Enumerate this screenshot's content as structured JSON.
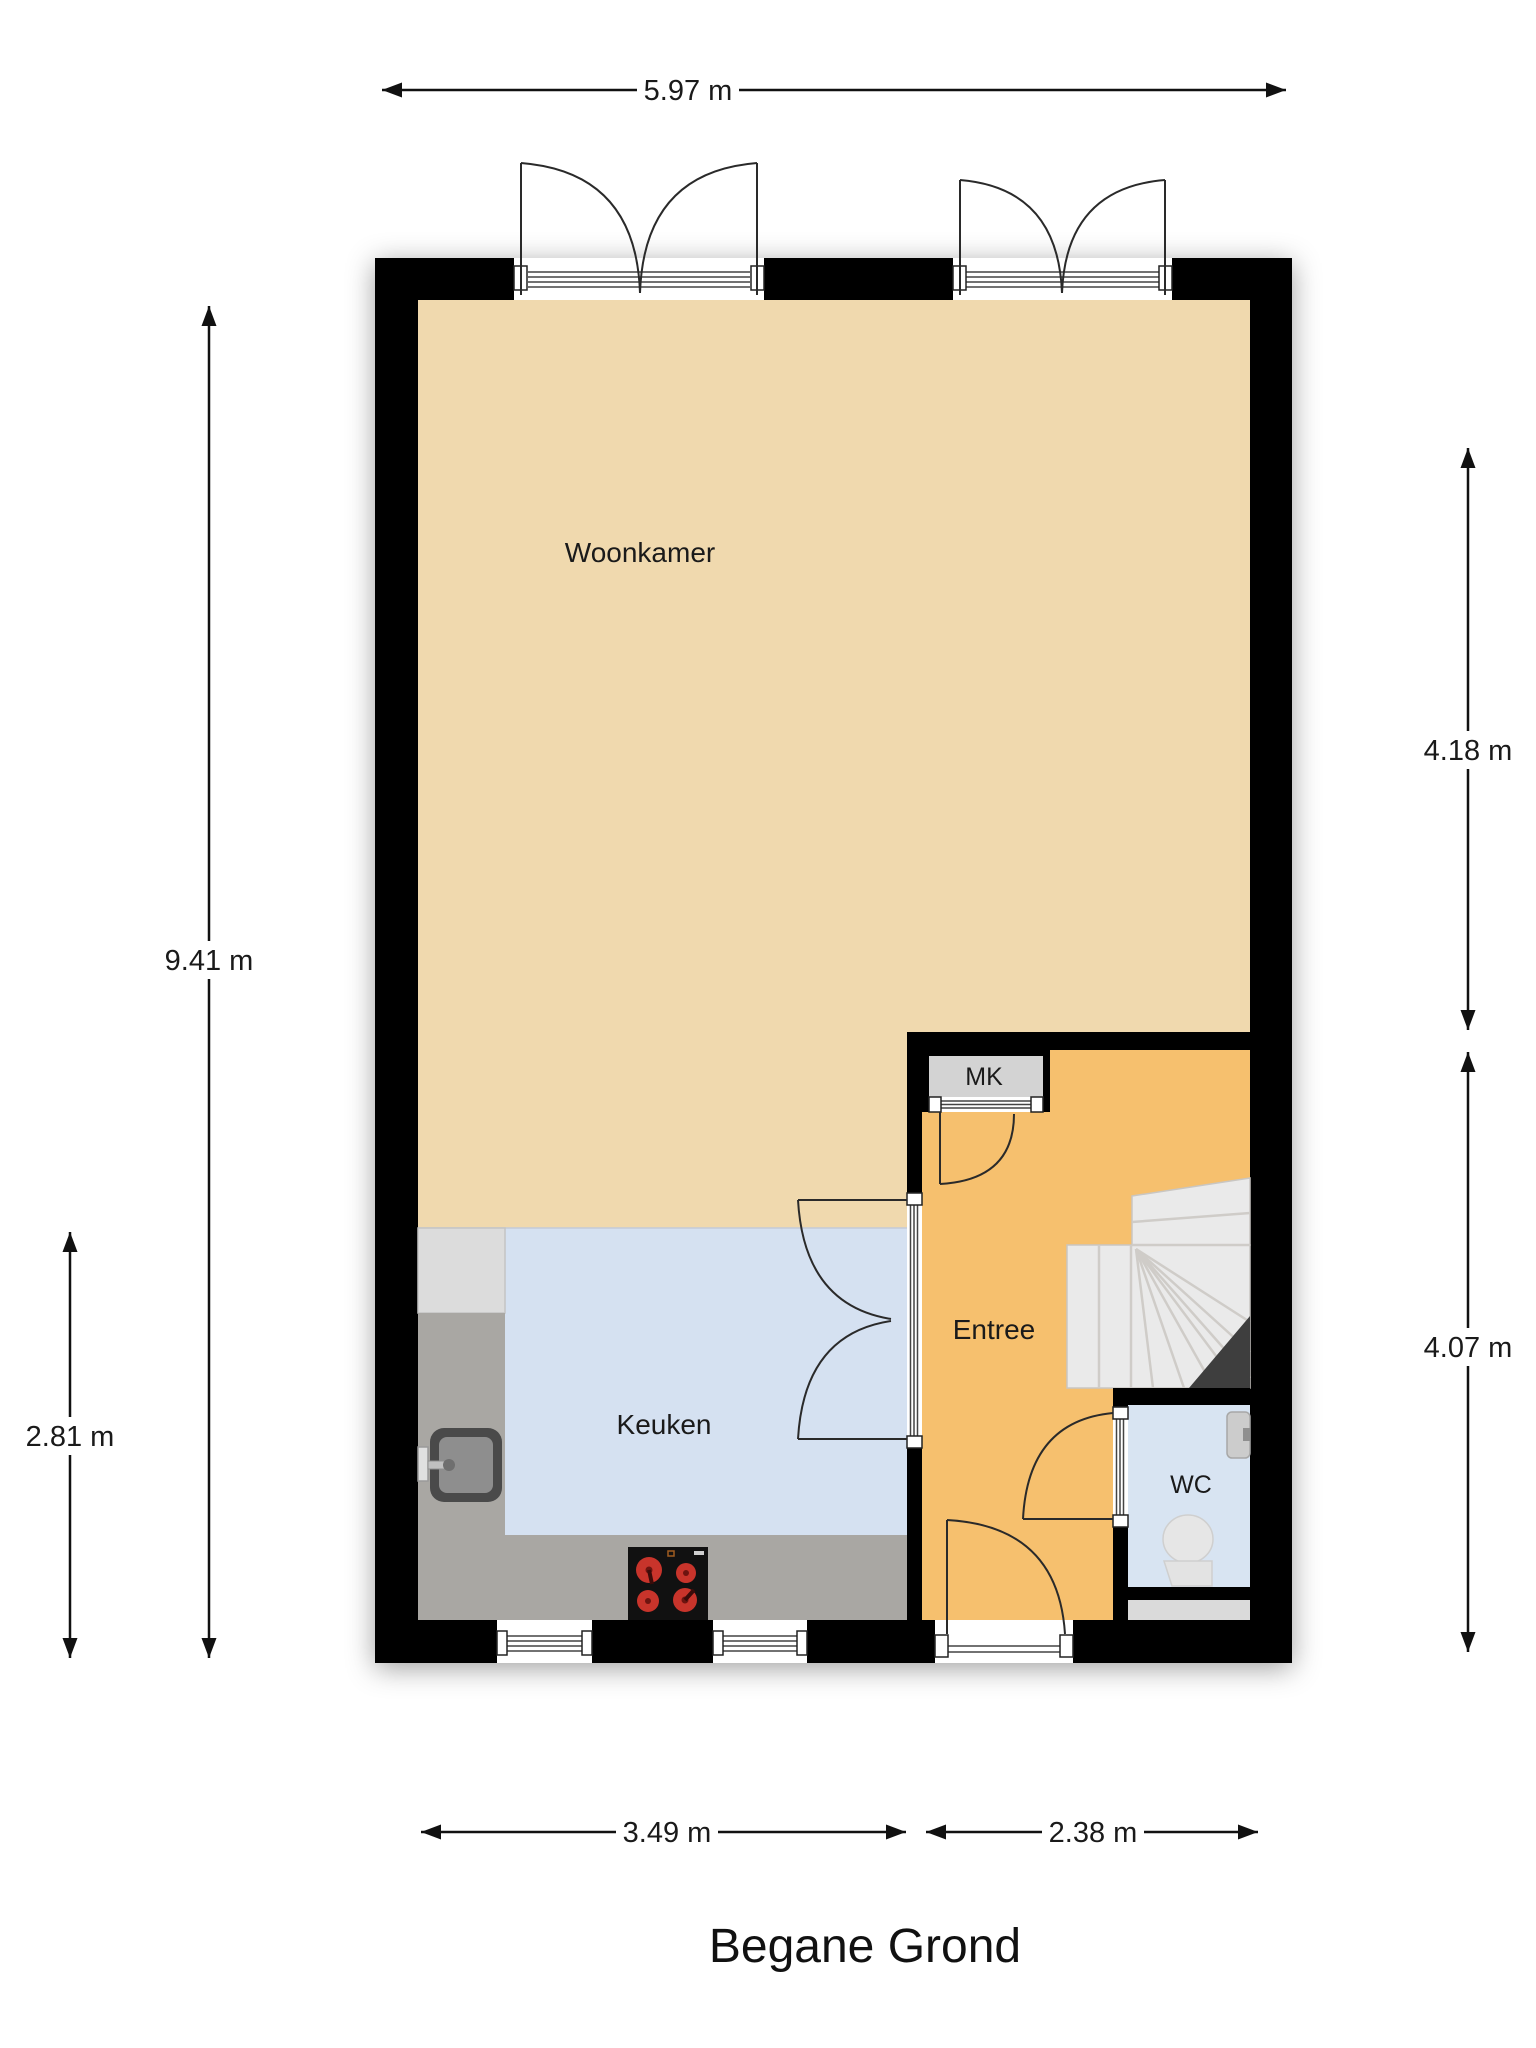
{
  "floorplan": {
    "title": "Begane Grond",
    "rooms": {
      "woonkamer": {
        "label": "Woonkamer"
      },
      "keuken": {
        "label": "Keuken"
      },
      "entree": {
        "label": "Entree"
      },
      "mk": {
        "label": "MK"
      },
      "wc": {
        "label": "WC"
      }
    },
    "dimensions": {
      "top_width": "5.97 m",
      "total_height_left": "9.41 m",
      "kitchen_height_left": "2.81 m",
      "upper_right": "4.18 m",
      "lower_right": "4.07 m",
      "bottom_kitchen_width": "3.49 m",
      "bottom_entree_width": "2.38 m"
    },
    "colors": {
      "wall": "#000000",
      "woonkamer_floor": "#F0D9AE",
      "entree_floor": "#F6C06E",
      "keuken_floor": "#D5E1F1",
      "wc_floor": "#D8E4F2",
      "counter": "#A9A7A3",
      "counter_light": "#DCDCDC",
      "mk_cabinet": "#D3D3D3",
      "stairs": "#EAEAEA",
      "stair_void": "#3E3E3E",
      "cooktop": "#111111",
      "burner_red": "#C8342B",
      "text": "#1A1A1A"
    }
  }
}
